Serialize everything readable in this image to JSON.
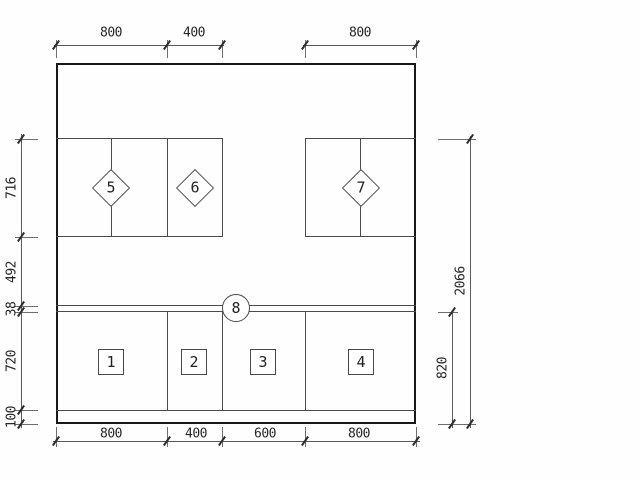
{
  "dimensions": {
    "top": [
      "800",
      "400",
      "800"
    ],
    "bottom": [
      "800",
      "400",
      "600",
      "800"
    ],
    "left": [
      "716",
      "492",
      "38",
      "720",
      "100"
    ],
    "right": [
      "2066",
      "820"
    ]
  },
  "tags": {
    "diamonds": [
      "5",
      "6",
      "7"
    ],
    "squares": [
      "1",
      "2",
      "3",
      "4"
    ],
    "circle": "8"
  },
  "colors": {
    "outline": "#181818",
    "thin_line": "#4a4a4a",
    "dimension_line": "#5a5a5a",
    "text": "#262626",
    "background": "#fefefe"
  }
}
